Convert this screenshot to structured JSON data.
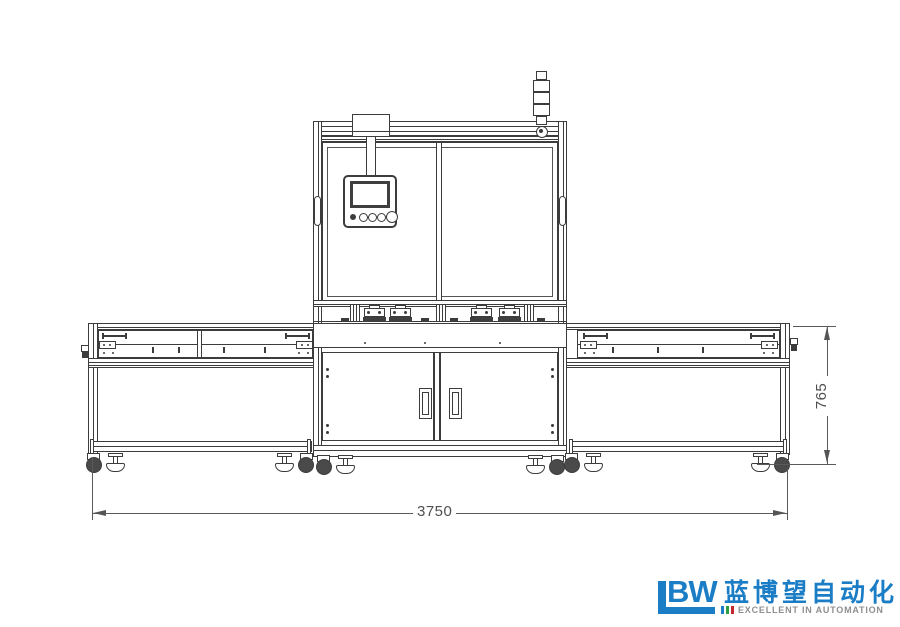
{
  "canvas": {
    "width": 900,
    "height": 627,
    "background": "#ffffff"
  },
  "drawing": {
    "kind": "engineering-front-elevation",
    "subject": "automated machine line with central control cabinet, HMI pendant, signal tower, two side conveyor tables, casters and leveling feet",
    "line_color": "#3c3c3c",
    "dimensions": {
      "overall_width": {
        "value": "3750",
        "orientation": "horizontal"
      },
      "frame_height": {
        "value": "765",
        "orientation": "vertical"
      }
    }
  },
  "logo": {
    "mark": "BW",
    "chinese_name": "蓝博望自动化",
    "tagline": "EXCELLENT IN AUTOMATION",
    "colors": {
      "blue": "#1a7dc5",
      "gray": "#8f8f8f",
      "bar_blue": "#1a7dc5",
      "bar_green": "#2f9e3f",
      "bar_red": "#c1272d"
    }
  }
}
